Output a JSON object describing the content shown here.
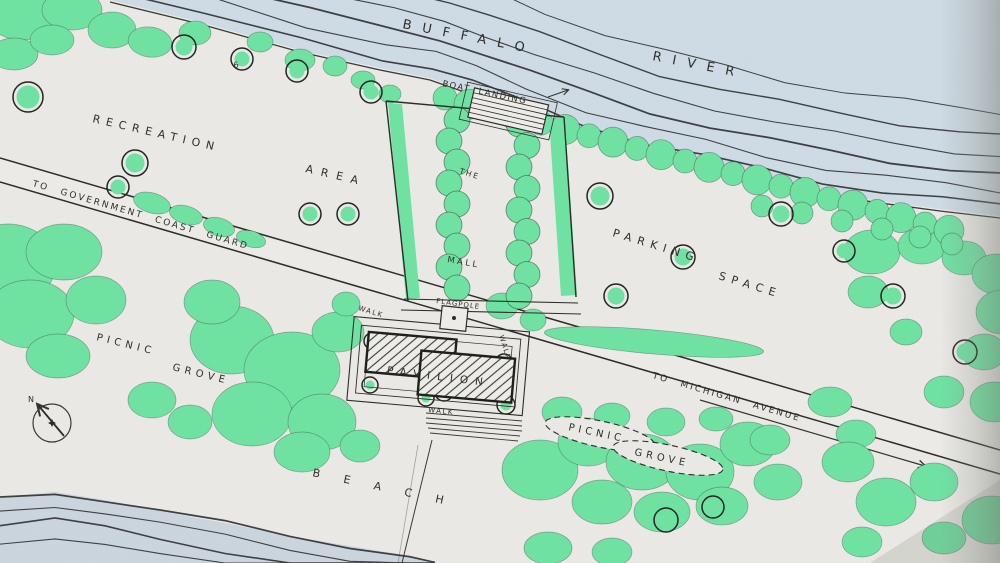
{
  "map": {
    "type": "hand-drawn park site plan",
    "labels": {
      "river_word1": "BUFFALO",
      "river_word2": "RIVER",
      "boat_landing": "BOAT LANDING",
      "recreation_word1": "RECREATION",
      "recreation_word2": "AREA",
      "mall_word1": "THE",
      "mall_word2": "MALL",
      "parking_word1": "PARKING",
      "parking_word2": "SPACE",
      "road_west": "TO GOVERNMENT COAST GUARD",
      "road_east": "TO MICHIGAN AVENUE",
      "flagpole": "FLAGPOLE",
      "pavilion": "PAVILION",
      "walk": "WALK",
      "picnic_west_word1": "PICNIC",
      "picnic_west_word2": "GROVE",
      "picnic_east_word1": "PICNIC",
      "picnic_east_word2": "GROVE",
      "beach": "BEACH",
      "compass_north": "N",
      "tree_marker": "6"
    },
    "colors": {
      "tree_green": "#6fe3a2",
      "water_blue": "#cfdce6",
      "paper": "#ebeae6",
      "ink": "#33332e"
    }
  }
}
